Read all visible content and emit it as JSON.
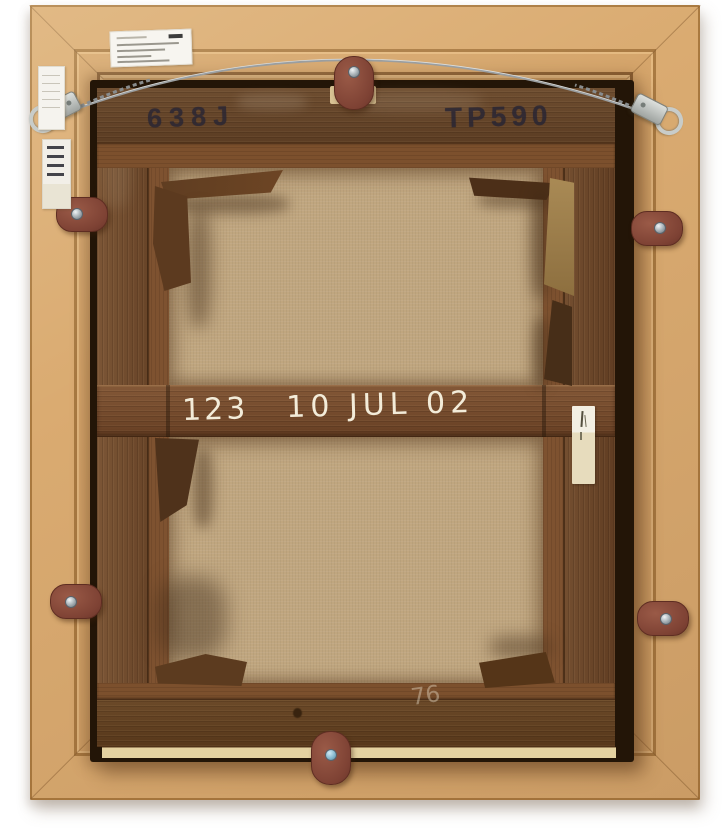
{
  "inscriptions": {
    "stamp_left": "638J",
    "stamp_right": "TP590",
    "chalk_number": "123",
    "chalk_date": "10 JUL 02",
    "chalk_bottom_faint": "76"
  },
  "colors": {
    "frame_tan": "#d5a56b",
    "stretcher_wood": "#6a4326",
    "canvas_tan": "#c0a67f",
    "pad_leather": "#8e4f3e",
    "wire_metal": "#a8abad",
    "label_white": "#f5f3ee",
    "chalk_white": "#f3ecd9",
    "stamp_ink": "#262434"
  }
}
